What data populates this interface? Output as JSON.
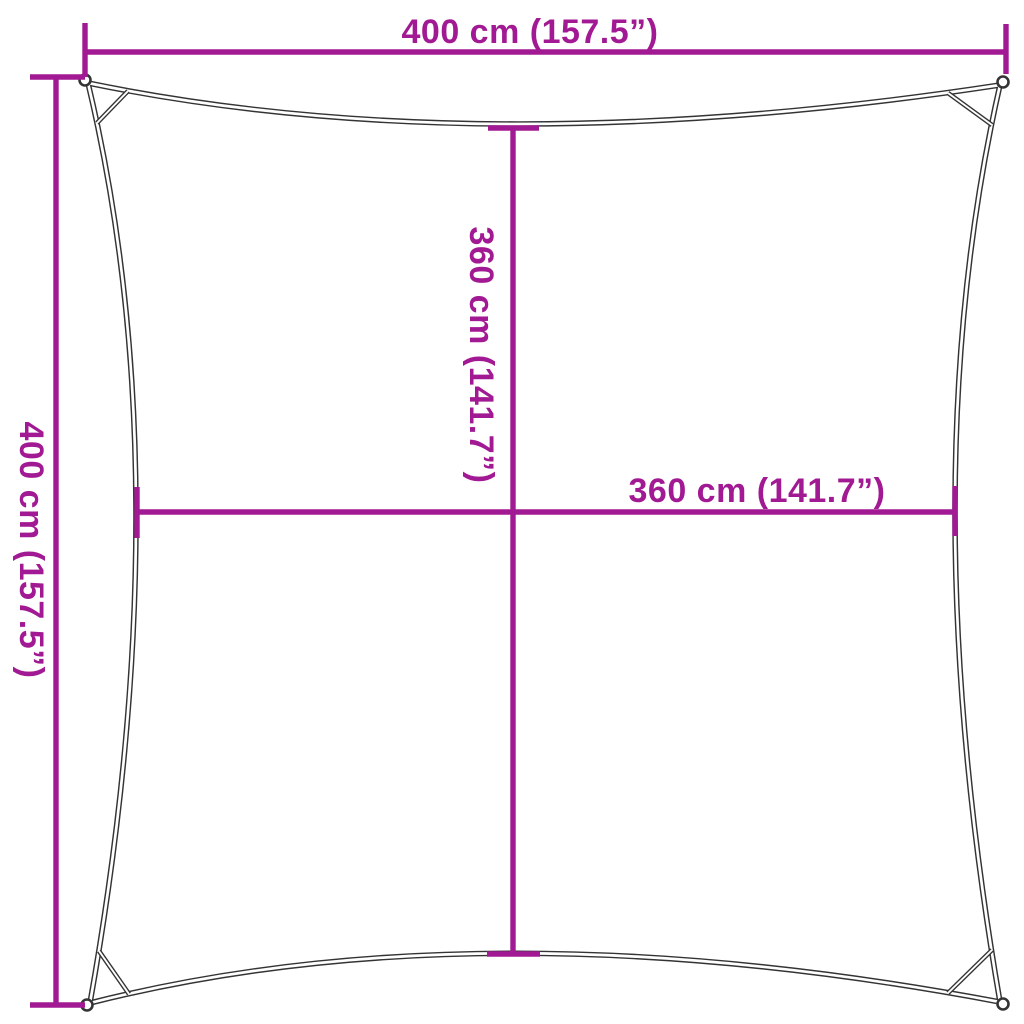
{
  "colors": {
    "accent": "#A21A93",
    "outline": "#343434",
    "background": "#FFFFFF"
  },
  "dimensions": {
    "top": {
      "label": "400 cm (157.5”)",
      "orientation": "horizontal"
    },
    "left": {
      "label": "400 cm (157.5”)",
      "orientation": "vertical"
    },
    "inner_vertical": {
      "label": "360 cm (141.7”)",
      "orientation": "vertical"
    },
    "inner_horizontal": {
      "label": "360 cm (141.7”)",
      "orientation": "horizontal"
    }
  }
}
